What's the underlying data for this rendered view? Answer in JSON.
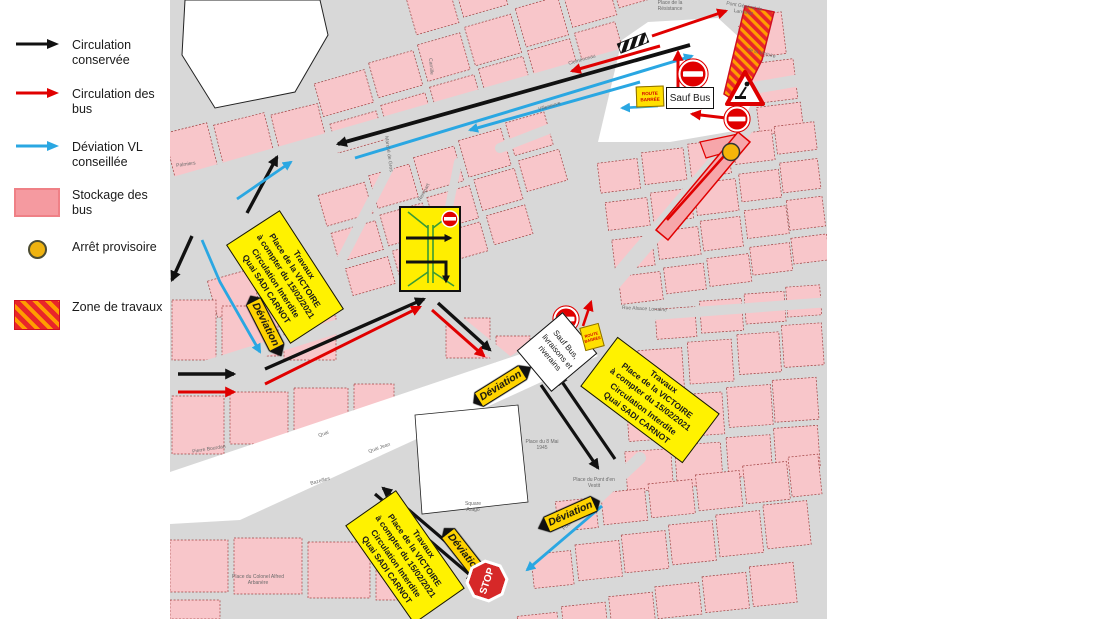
{
  "legend": {
    "items": [
      {
        "symbol": "black-arrow-icon",
        "label": "Circulation conservée"
      },
      {
        "symbol": "red-arrow-icon",
        "label": "Circulation des bus"
      },
      {
        "symbol": "blue-arrow-icon",
        "label": "Déviation VL conseillée"
      },
      {
        "symbol": "pink-swatch",
        "label": "Stockage des bus"
      },
      {
        "symbol": "yellow-dot",
        "label": "Arrêt provisoire"
      },
      {
        "symbol": "hatched-swatch",
        "label": "Zone de travaux"
      }
    ]
  },
  "signs": {
    "travaux_box_lines": [
      "Travaux",
      "Place de la VICTOIRE",
      "à compter du 15/02/2021",
      "Circulation Interdite",
      "Quai SADI CARNOT"
    ],
    "sauf_bus": "Sauf Bus",
    "sauf_bus_livraisons_lines": [
      "Sauf Bus,",
      "livraisons et",
      "riverains"
    ],
    "route_barree_lines": [
      "ROUTE",
      "BARRÉE"
    ],
    "deviation_label": "Déviation",
    "stop_label": "STOP"
  },
  "map": {
    "street_labels": [
      {
        "t": "Clemenceau"
      },
      {
        "t": "Villeneuve"
      },
      {
        "t": "Rempart"
      },
      {
        "t": "Place de la Résistance"
      },
      {
        "t": "Pont Général de Larminat"
      },
      {
        "t": "de la Victoire"
      },
      {
        "t": "Rue Alsace Lorraine"
      },
      {
        "t": "Place du 8 Mai 1945"
      },
      {
        "t": "Square Arago"
      },
      {
        "t": "Place du Pont d'en Vestit"
      },
      {
        "t": "Pierre Bourdan"
      },
      {
        "t": "Quai Jean"
      },
      {
        "t": "Bazeilles"
      },
      {
        "t": "Place du Colonel Alfred Arbanère"
      },
      {
        "t": "Foch"
      },
      {
        "t": "Palmiers"
      },
      {
        "t": "Marché de Gros"
      },
      {
        "t": "Camille"
      },
      {
        "t": "Quai"
      }
    ]
  },
  "colors": {
    "circulation_conservee": "#111111",
    "circulation_bus": "#e00000",
    "deviation_vl": "#2aa7e2",
    "stockage_bus": "#f59aa0",
    "arret_provisoire": "#efb310",
    "zone_travaux_red": "#e8252a",
    "zone_travaux_orange": "#ff9d00",
    "sign_yellow": "#fff200"
  }
}
